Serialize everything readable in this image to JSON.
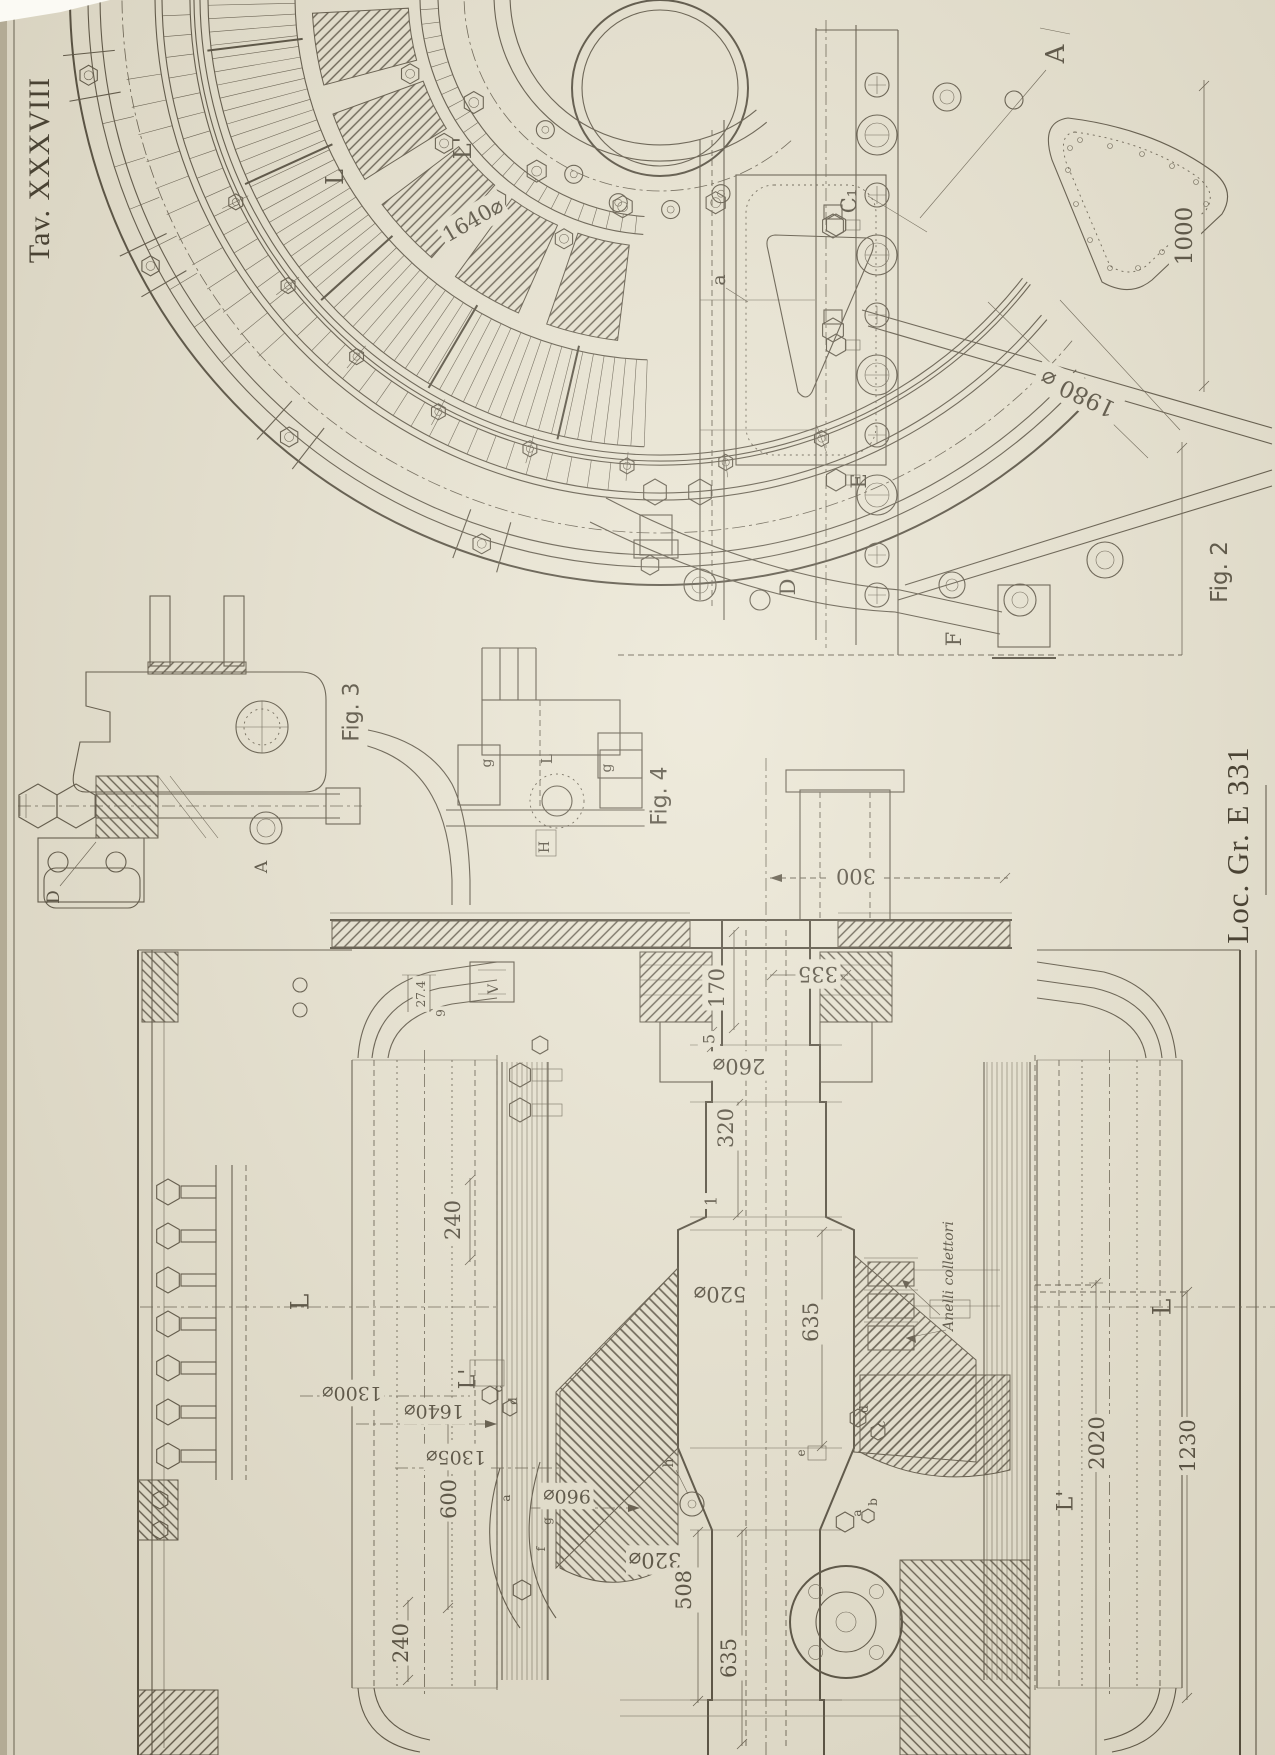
{
  "sheet": {
    "tav": "Tav. XXXVIII",
    "loc": "Loc. Gr. E 331"
  },
  "colors": {
    "paper": "#e9e4d2",
    "ink": "#4a4334",
    "edge": "#b3ab95"
  },
  "captions": {
    "fig2": "Fig. 2",
    "fig3": "Fig. 3",
    "fig4": "Fig. 4"
  },
  "annotations": {
    "slip_rings": "Anelli collettori"
  },
  "labels": [
    {
      "n": "fig2-caption",
      "t": "Fig. 2",
      "x": 1220,
      "y": 572,
      "r": -90,
      "s": 23,
      "f": "sans"
    },
    {
      "n": "fig3-caption",
      "t": "Fig. 3",
      "x": 352,
      "y": 712,
      "r": -90,
      "s": 22,
      "f": "sans"
    },
    {
      "n": "fig4-caption",
      "t": "Fig. 4",
      "x": 660,
      "y": 796,
      "r": -90,
      "s": 22,
      "f": "sans"
    },
    {
      "n": "part-A-fig2",
      "t": "A",
      "x": 1056,
      "y": 54,
      "r": -90,
      "s": 26,
      "f": "serif"
    },
    {
      "n": "part-L-fig2",
      "t": "L",
      "x": 335,
      "y": 177,
      "r": -90,
      "s": 24,
      "f": "serif"
    },
    {
      "n": "part-L1-fig2",
      "t": "L'",
      "x": 463,
      "y": 148,
      "r": -90,
      "s": 24,
      "f": "serif"
    },
    {
      "n": "dia-1640-fig2",
      "t": "1640⌀",
      "x": 473,
      "y": 220,
      "r": -30,
      "s": 21,
      "f": "serif"
    },
    {
      "n": "part-C1-fig2",
      "t": "C₁",
      "x": 849,
      "y": 201,
      "r": -90,
      "s": 21,
      "f": "serif"
    },
    {
      "n": "part-a-fig2",
      "t": "a",
      "x": 719,
      "y": 280,
      "r": -90,
      "s": 19,
      "f": "serif"
    },
    {
      "n": "dim-1000",
      "t": "1000",
      "x": 1185,
      "y": 236,
      "r": -90,
      "s": 23,
      "f": "serif"
    },
    {
      "n": "dia-1980",
      "t": "1980 ⌀",
      "x": 1078,
      "y": 393,
      "r": 205,
      "s": 23,
      "f": "serif"
    },
    {
      "n": "part-E",
      "t": "E",
      "x": 859,
      "y": 481,
      "r": -90,
      "s": 21,
      "f": "serif"
    },
    {
      "n": "part-F",
      "t": "F",
      "x": 954,
      "y": 639,
      "r": -90,
      "s": 21,
      "f": "serif"
    },
    {
      "n": "part-D-fig2",
      "t": "D",
      "x": 788,
      "y": 587,
      "r": -90,
      "s": 21,
      "f": "serif"
    },
    {
      "n": "part-D-fig3",
      "t": "D",
      "x": 54,
      "y": 897,
      "r": -90,
      "s": 17,
      "f": "serif"
    },
    {
      "n": "part-A-fig3",
      "t": "A",
      "x": 262,
      "y": 867,
      "r": -90,
      "s": 17,
      "f": "serif"
    },
    {
      "n": "part-g1-fig4",
      "t": "g",
      "x": 487,
      "y": 763,
      "r": -90,
      "s": 14,
      "f": "serif"
    },
    {
      "n": "part-g2-fig4",
      "t": "g",
      "x": 607,
      "y": 768,
      "r": -90,
      "s": 14,
      "f": "serif"
    },
    {
      "n": "part-L-fig4",
      "t": "L",
      "x": 547,
      "y": 759,
      "r": -90,
      "s": 15,
      "f": "serif"
    },
    {
      "n": "part-H-fig4",
      "t": "H",
      "x": 545,
      "y": 847,
      "r": -90,
      "s": 14,
      "f": "serif"
    },
    {
      "n": "dim-300",
      "t": "300",
      "x": 856,
      "y": 876,
      "r": 180,
      "s": 21,
      "f": "serif"
    },
    {
      "n": "dim-335",
      "t": "335",
      "x": 818,
      "y": 974,
      "r": 180,
      "s": 21,
      "f": "serif"
    },
    {
      "n": "dim-170",
      "t": "170",
      "x": 717,
      "y": 988,
      "r": -90,
      "s": 21,
      "f": "serif"
    },
    {
      "n": "dim-5",
      "t": "5",
      "x": 709,
      "y": 1039,
      "r": -90,
      "s": 16,
      "f": "serif"
    },
    {
      "n": "dia-260",
      "t": "260⌀",
      "x": 739,
      "y": 1066,
      "r": 180,
      "s": 21,
      "f": "serif"
    },
    {
      "n": "dim-320",
      "t": "320",
      "x": 726,
      "y": 1128,
      "r": -90,
      "s": 21,
      "f": "serif"
    },
    {
      "n": "dim-1",
      "t": "1",
      "x": 711,
      "y": 1201,
      "r": -90,
      "s": 16,
      "f": "serif"
    },
    {
      "n": "dia-520",
      "t": "520⌀",
      "x": 720,
      "y": 1294,
      "r": 180,
      "s": 21,
      "f": "serif"
    },
    {
      "n": "dim-635-upper",
      "t": "635",
      "x": 811,
      "y": 1322,
      "r": -90,
      "s": 21,
      "f": "serif"
    },
    {
      "n": "dia-320",
      "t": "320⌀",
      "x": 655,
      "y": 1560,
      "r": 180,
      "s": 21,
      "f": "serif"
    },
    {
      "n": "dim-508",
      "t": "508",
      "x": 684,
      "y": 1590,
      "r": -90,
      "s": 21,
      "f": "serif"
    },
    {
      "n": "dim-635-lower",
      "t": "635",
      "x": 729,
      "y": 1658,
      "r": -90,
      "s": 21,
      "f": "serif"
    },
    {
      "n": "dim-240-upper",
      "t": "240",
      "x": 453,
      "y": 1220,
      "r": -90,
      "s": 21,
      "f": "serif"
    },
    {
      "n": "part-L1-left",
      "t": "L'",
      "x": 468,
      "y": 1379,
      "r": -90,
      "s": 22,
      "f": "serif"
    },
    {
      "n": "dia-1640-fig1",
      "t": "1640⌀",
      "x": 434,
      "y": 1411,
      "r": 180,
      "s": 19,
      "f": "serif"
    },
    {
      "n": "dia-1305",
      "t": "1305⌀",
      "x": 456,
      "y": 1457,
      "r": 180,
      "s": 19,
      "f": "serif"
    },
    {
      "n": "dia-1300",
      "t": "1300⌀",
      "x": 352,
      "y": 1393,
      "r": 180,
      "s": 19,
      "f": "serif"
    },
    {
      "n": "dim-600",
      "t": "600",
      "x": 449,
      "y": 1499,
      "r": -90,
      "s": 21,
      "f": "serif"
    },
    {
      "n": "dia-960",
      "t": "960⌀",
      "x": 567,
      "y": 1496,
      "r": 180,
      "s": 19,
      "f": "serif"
    },
    {
      "n": "part-L-left",
      "t": "L",
      "x": 300,
      "y": 1302,
      "r": -90,
      "s": 25,
      "f": "serif"
    },
    {
      "n": "slip-rings-note",
      "t": "Anelli collettori",
      "x": 949,
      "y": 1276,
      "r": -90,
      "s": 14,
      "f": "italic"
    },
    {
      "n": "dim-2020",
      "t": "2020",
      "x": 1097,
      "y": 1443,
      "r": -90,
      "s": 21,
      "f": "serif"
    },
    {
      "n": "dim-1230",
      "t": "1230",
      "x": 1188,
      "y": 1446,
      "r": -90,
      "s": 21,
      "f": "serif"
    },
    {
      "n": "part-L1-right",
      "t": "L'",
      "x": 1066,
      "y": 1501,
      "r": -90,
      "s": 22,
      "f": "serif"
    },
    {
      "n": "part-L-right",
      "t": "L",
      "x": 1162,
      "y": 1307,
      "r": -90,
      "s": 25,
      "f": "serif"
    },
    {
      "n": "dim-27-4",
      "t": "27.4",
      "x": 421,
      "y": 994,
      "r": -90,
      "s": 12,
      "f": "serif"
    },
    {
      "n": "dim-9",
      "t": "9",
      "x": 441,
      "y": 1013,
      "r": -90,
      "s": 12,
      "f": "serif"
    },
    {
      "n": "part-V",
      "t": "V",
      "x": 494,
      "y": 989,
      "r": -90,
      "s": 14,
      "f": "serif"
    },
    {
      "n": "part-h",
      "t": "h",
      "x": 669,
      "y": 1463,
      "r": -90,
      "s": 14,
      "f": "serif"
    },
    {
      "n": "part-c-left",
      "t": "c",
      "x": 498,
      "y": 1389,
      "r": -90,
      "s": 12,
      "f": "serif"
    },
    {
      "n": "part-d-left",
      "t": "d",
      "x": 513,
      "y": 1401,
      "r": -90,
      "s": 12,
      "f": "serif"
    },
    {
      "n": "part-e-right",
      "t": "e",
      "x": 801,
      "y": 1453,
      "r": -90,
      "s": 12,
      "f": "serif"
    },
    {
      "n": "part-d-right",
      "t": "d",
      "x": 864,
      "y": 1409,
      "r": -90,
      "s": 12,
      "f": "serif"
    },
    {
      "n": "part-c-right",
      "t": "c",
      "x": 881,
      "y": 1424,
      "r": -90,
      "s": 12,
      "f": "serif"
    },
    {
      "n": "part-a-right",
      "t": "a",
      "x": 857,
      "y": 1513,
      "r": -90,
      "s": 12,
      "f": "serif"
    },
    {
      "n": "part-b-right",
      "t": "b",
      "x": 873,
      "y": 1502,
      "r": -90,
      "s": 12,
      "f": "serif"
    },
    {
      "n": "part-g-bottom",
      "t": "g",
      "x": 547,
      "y": 1521,
      "r": -90,
      "s": 12,
      "f": "serif"
    },
    {
      "n": "part-f-bottom",
      "t": "f",
      "x": 541,
      "y": 1549,
      "r": -90,
      "s": 12,
      "f": "serif"
    },
    {
      "n": "part-a-left",
      "t": "a",
      "x": 506,
      "y": 1498,
      "r": -90,
      "s": 12,
      "f": "serif"
    },
    {
      "n": "dim-240-lower",
      "t": "240",
      "x": 401,
      "y": 1643,
      "r": -90,
      "s": 21,
      "f": "serif"
    }
  ]
}
